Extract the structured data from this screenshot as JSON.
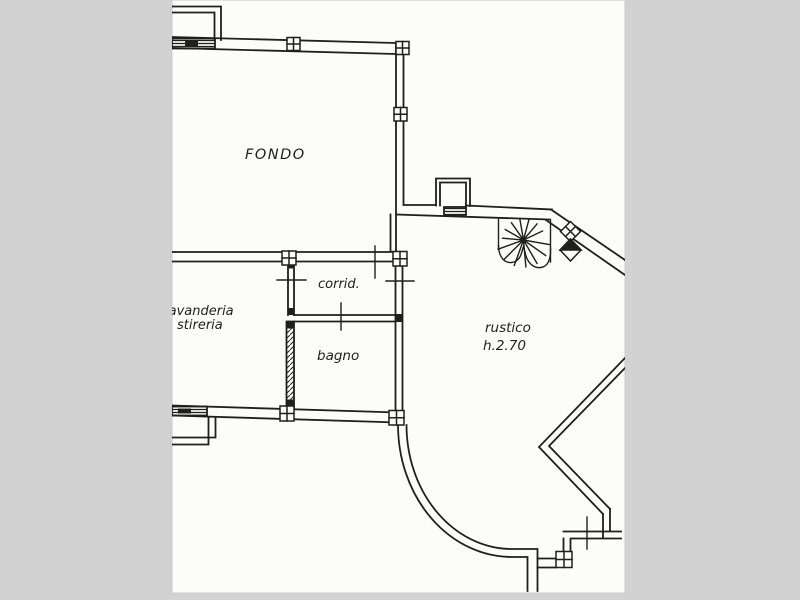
{
  "colors": {
    "background_gray": "#d2d2d2",
    "paper_white": "#fcfcfb",
    "ink": "#1f1f1f"
  },
  "plan": {
    "type": "scanned cadastral floor plan",
    "labels": {
      "fondo": "FONDO",
      "lavanderia": "lavanderia",
      "stireria": "stireria",
      "corridoio": "corrid.",
      "bagno": "bagno",
      "rustico": "rustico",
      "rustico_height": "h.2.70"
    },
    "features": [
      "spiral-staircase",
      "door-niche",
      "hatched-windows",
      "hatched-partition-wall",
      "wall-pillars",
      "curved-exterior-wall",
      "diagonal-walls"
    ]
  }
}
